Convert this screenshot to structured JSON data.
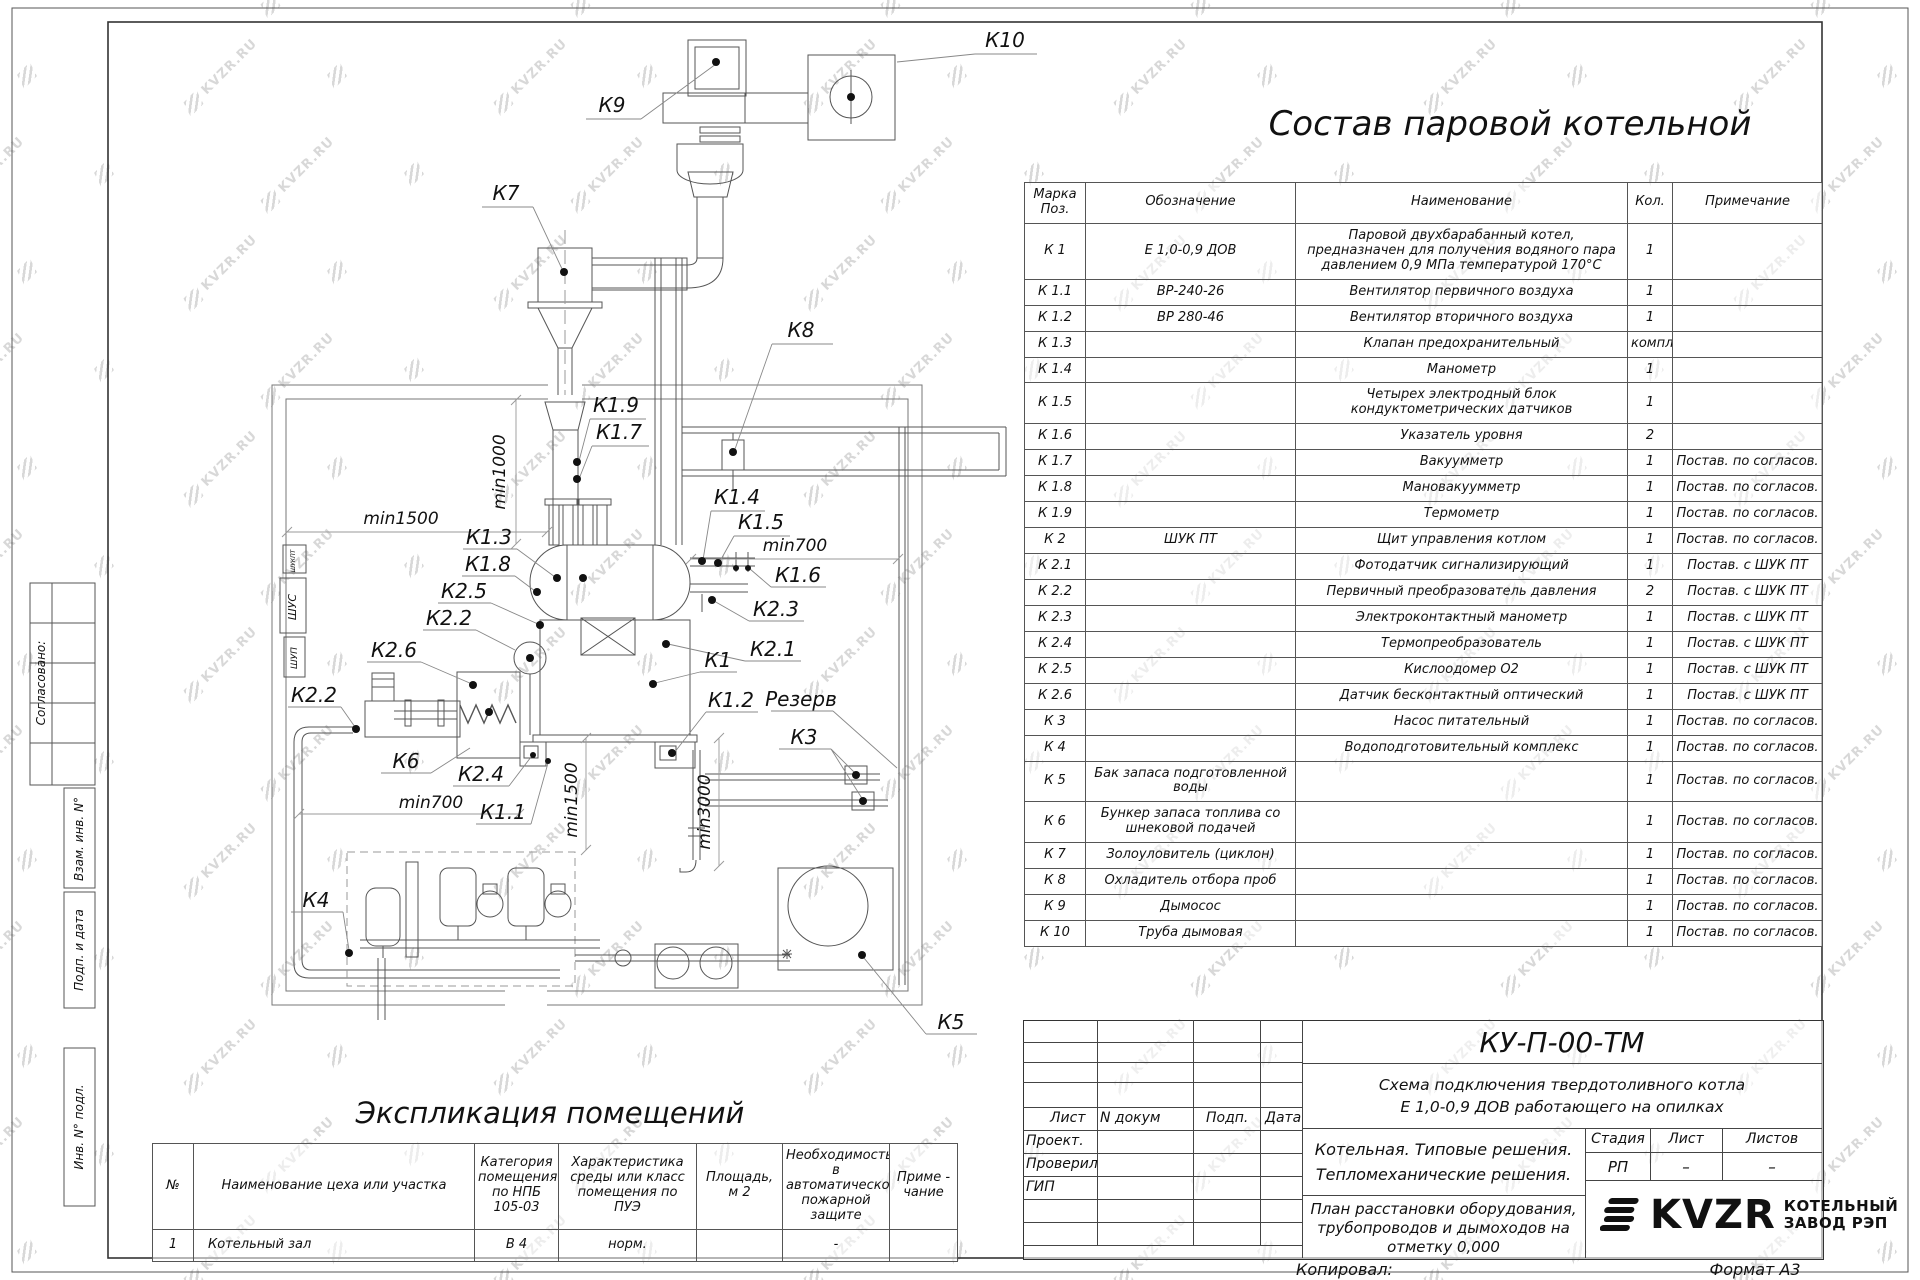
{
  "watermark": {
    "text": "KVZR.RU"
  },
  "headings": {
    "parts_title": "Состав паровой котельной",
    "explication_title": "Экспликация помещений"
  },
  "parts_table": {
    "headers": {
      "mark": "Марка\nПоз.",
      "code": "Обозначение",
      "name": "Наименование",
      "qty": "Кол.",
      "note": "Примечание"
    },
    "rows": [
      {
        "mark": "К 1",
        "code": "Е 1,0-0,9 ДОВ",
        "name": "Паровой двухбарабанный котел,\nпредназначен для получения водяного пара\nдавлением 0,9 МПа температурой 170°С",
        "qty": "1",
        "note": ""
      },
      {
        "mark": "К 1.1",
        "code": "ВР-240-26",
        "name": "Вентилятор первичного воздуха",
        "qty": "1",
        "note": ""
      },
      {
        "mark": "К 1.2",
        "code": "ВР 280-46",
        "name": "Вентилятор вторичного воздуха",
        "qty": "1",
        "note": ""
      },
      {
        "mark": "К 1.3",
        "code": "",
        "name": "Клапан предохранительный",
        "qty": "компл.",
        "note": ""
      },
      {
        "mark": "К 1.4",
        "code": "",
        "name": "Манометр",
        "qty": "1",
        "note": ""
      },
      {
        "mark": "К 1.5",
        "code": "",
        "name": "Четырех электродный блок\nкондуктометрических датчиков",
        "qty": "1",
        "note": ""
      },
      {
        "mark": "К 1.6",
        "code": "",
        "name": "Указатель уровня",
        "qty": "2",
        "note": ""
      },
      {
        "mark": "К 1.7",
        "code": "",
        "name": "Вакуумметр",
        "qty": "1",
        "note": "Постав. по согласов."
      },
      {
        "mark": "К 1.8",
        "code": "",
        "name": "Мановакуумметр",
        "qty": "1",
        "note": "Постав. по согласов."
      },
      {
        "mark": "К 1.9",
        "code": "",
        "name": "Термометр",
        "qty": "1",
        "note": "Постав. по согласов."
      },
      {
        "mark": "К 2",
        "code": "ШУК ПТ",
        "name": "Щит управления котлом",
        "qty": "1",
        "note": "Постав. по согласов."
      },
      {
        "mark": "К 2.1",
        "code": "",
        "name": "Фотодатчик сигнализирующий",
        "qty": "1",
        "note": "Постав. с ШУК ПТ"
      },
      {
        "mark": "К 2.2",
        "code": "",
        "name": "Первичный преобразователь давления",
        "qty": "2",
        "note": "Постав. с ШУК ПТ"
      },
      {
        "mark": "К 2.3",
        "code": "",
        "name": "Электроконтактный манометр",
        "qty": "1",
        "note": "Постав. с ШУК ПТ"
      },
      {
        "mark": "К 2.4",
        "code": "",
        "name": "Термопреобразователь",
        "qty": "1",
        "note": "Постав. с ШУК ПТ"
      },
      {
        "mark": "К 2.5",
        "code": "",
        "name": "Кислоодомер О2",
        "qty": "1",
        "note": "Постав. с ШУК ПТ"
      },
      {
        "mark": "К 2.6",
        "code": "",
        "name": "Датчик бесконтактный оптический",
        "qty": "1",
        "note": "Постав. с ШУК ПТ"
      },
      {
        "mark": "К 3",
        "code": "",
        "name": "Насос питательный",
        "qty": "1",
        "note": "Постав. по согласов."
      },
      {
        "mark": "К 4",
        "code": "",
        "name": "Водоподготовительный комплекс",
        "qty": "1",
        "note": "Постав. по согласов."
      },
      {
        "mark": "К 5",
        "code": "Бак запаса подготовленной\nводы",
        "name": "",
        "qty": "1",
        "note": "Постав. по согласов."
      },
      {
        "mark": "К 6",
        "code": "Бункер запаса топлива со\nшнековой подачей",
        "name": "",
        "qty": "1",
        "note": "Постав. по согласов."
      },
      {
        "mark": "К 7",
        "code": "Золоуловитель (циклон)",
        "name": "",
        "qty": "1",
        "note": "Постав. по согласов."
      },
      {
        "mark": "К 8",
        "code": "Охладитель отбора проб",
        "name": "",
        "qty": "1",
        "note": "Постав. по согласов."
      },
      {
        "mark": "К 9",
        "code": "Дымосос",
        "name": "",
        "qty": "1",
        "note": "Постав. по согласов."
      },
      {
        "mark": "К 10",
        "code": "Труба дымовая",
        "name": "",
        "qty": "1",
        "note": "Постав. по согласов."
      }
    ]
  },
  "explication": {
    "headers": {
      "num": "№",
      "name": "Наименование цеха или участка",
      "category": "Категория\nпомещения\nпо НПБ\n105-03",
      "env": "Характеристика\nсреды или класс\nпомещения по\nПУЭ",
      "area": "Площадь,\nм 2",
      "fire": "Необходимость в\nавтоматической\nпожарной защите",
      "note": "Приме -\nчание"
    },
    "rows": [
      {
        "num": "1",
        "name": "Котельный зал",
        "category": "В 4",
        "env": "норм.",
        "area": "",
        "fire": "-",
        "note": ""
      }
    ]
  },
  "title_block": {
    "doc_code": "КУ-П-00-ТМ",
    "scheme_line1": "Схема подключения твердотоливного котла",
    "scheme_line2": "Е 1,0-0,9  ДОВ работающего на опилках",
    "section_line1": "Котельная. Типовые решения.",
    "section_line2": "Тепломеханические решения.",
    "obj_line1": "План расстановки оборудования,",
    "obj_line2": "трубопроводов и дымоходов на",
    "obj_line3": "отметку 0,000",
    "col_sheet": "Лист",
    "col_doc": "N докум",
    "col_sign": "Подп.",
    "col_date": "Дата",
    "role_design": "Проект.",
    "role_check": "Проверил",
    "role_gip": "ГИП",
    "stage_label": "Стадия",
    "sheet_label": "Лист",
    "sheets_label": "Листов",
    "stage_value": "РП",
    "sheet_value": "–",
    "sheets_value": "–",
    "copied": "Копировал:",
    "format": "Формат А3",
    "logo": "KVZR",
    "company1": "КОТЕЛЬНЫЙ",
    "company2": "ЗАВОД РЭП"
  },
  "margin": {
    "approved": "Согласовано:",
    "replace_inv": "Взам. инв. N°",
    "sign_date": "Подп. и дата",
    "inv_orig": "Инв. N° подл."
  },
  "diagram": {
    "labels": [
      "К10",
      "К9",
      "К7",
      "К8",
      "К1.9",
      "К1.7",
      "К1.4",
      "К1.5",
      "min700",
      "min1500",
      "min1000",
      "К1.3",
      "К1.8",
      "К2.5",
      "К1.6",
      "К2.2",
      "К2.3",
      "К2.6",
      "К1",
      "К2.1",
      "К2.2",
      "К1.2",
      "Резерв",
      "К6",
      "К3",
      "К2.4",
      "min700",
      "К1.1",
      "min1500",
      "min3000",
      "К4",
      "К5"
    ],
    "panels": [
      "ШУКПТ",
      "ШУС",
      "ШУП"
    ]
  }
}
